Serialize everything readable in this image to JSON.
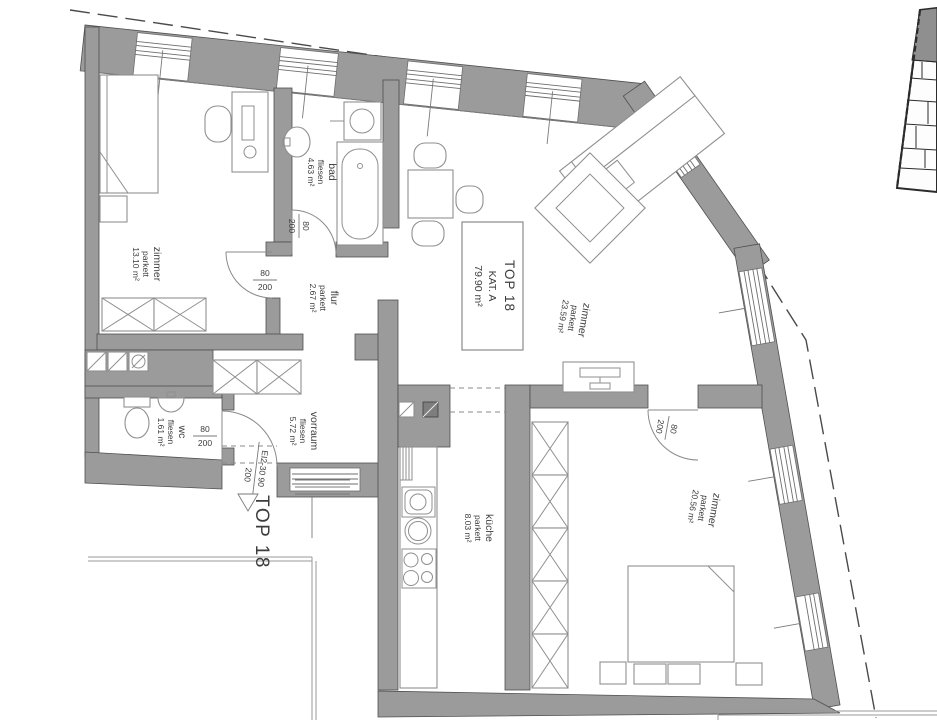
{
  "floor_plan": {
    "unit": {
      "name": "TOP 18",
      "category": "KAT. A",
      "total_area": "79.90 m²"
    },
    "corridor_label": "TOP 18",
    "rooms": [
      {
        "id": "zimmer-nw",
        "name": "zimmer",
        "floor": "parkett",
        "area": "13.10 m²"
      },
      {
        "id": "bad",
        "name": "bad",
        "floor": "fliesen",
        "area": "4.63 m²"
      },
      {
        "id": "flur",
        "name": "flur",
        "floor": "parkett",
        "area": "2.67 m²"
      },
      {
        "id": "zimmer-e",
        "name": "zimmer",
        "floor": "parkett",
        "area": "23.59 m²"
      },
      {
        "id": "wc",
        "name": "wc",
        "floor": "fliesen",
        "area": "1.61 m²"
      },
      {
        "id": "vorraum",
        "name": "vorraum",
        "floor": "fliesen",
        "area": "5.72 m²"
      },
      {
        "id": "kueche",
        "name": "küche",
        "floor": "parkett",
        "area": "8.03 m²"
      },
      {
        "id": "zimmer-se",
        "name": "zimmer",
        "floor": "parkett",
        "area": "20.56 m²"
      }
    ],
    "doors": {
      "width": "80",
      "height": "200",
      "entrance_spec": "EI2-30 90",
      "entrance_height": "200"
    },
    "colors": {
      "wall": "#9b9b9b",
      "outline": "#4f4f4f",
      "furniture": "#8f8f8f",
      "text": "#3c3c3c",
      "background": "#ffffff"
    }
  }
}
